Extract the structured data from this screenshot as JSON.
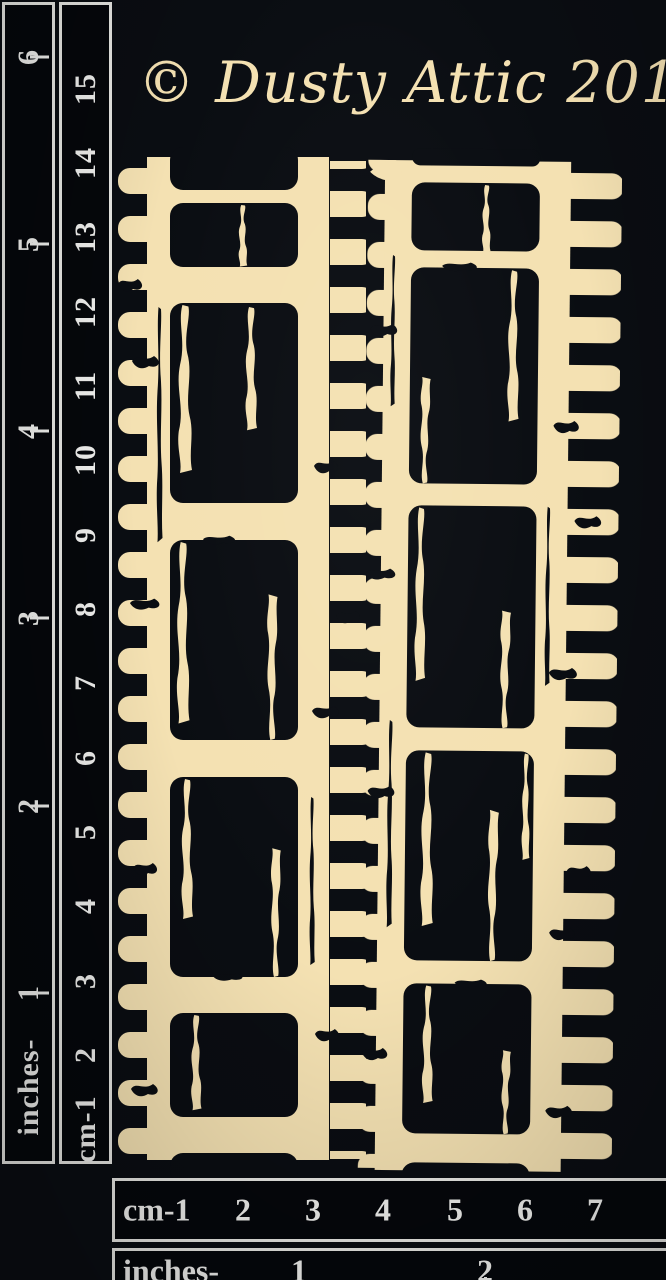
{
  "watermark": {
    "text": "© Dusty Attic 2017"
  },
  "product": {
    "description": "Two distressed film-strip chipboard pieces on black photo board"
  },
  "colors": {
    "background": "#0a0d12",
    "chipboard": "#f4e1b2",
    "ruler_text": "#f0f0ee",
    "ruler_border": "#e8e8e4",
    "ruler_bg": "#05070b"
  },
  "left_ruler": {
    "inches": {
      "unit_label": "inches-",
      "marks": [
        "1",
        "2",
        "3",
        "4",
        "5",
        "6"
      ]
    },
    "cm": {
      "unit_label": "cm-1",
      "marks": [
        "2",
        "3",
        "4",
        "5",
        "6",
        "7",
        "8",
        "9",
        "10",
        "11",
        "12",
        "13",
        "14",
        "15"
      ]
    }
  },
  "bottom_ruler": {
    "cm": {
      "unit_label": "cm-1",
      "marks": [
        "2",
        "3",
        "4",
        "5",
        "6",
        "7"
      ]
    },
    "inches": {
      "unit_label": "inches-",
      "marks": [
        "1",
        "2"
      ]
    }
  }
}
